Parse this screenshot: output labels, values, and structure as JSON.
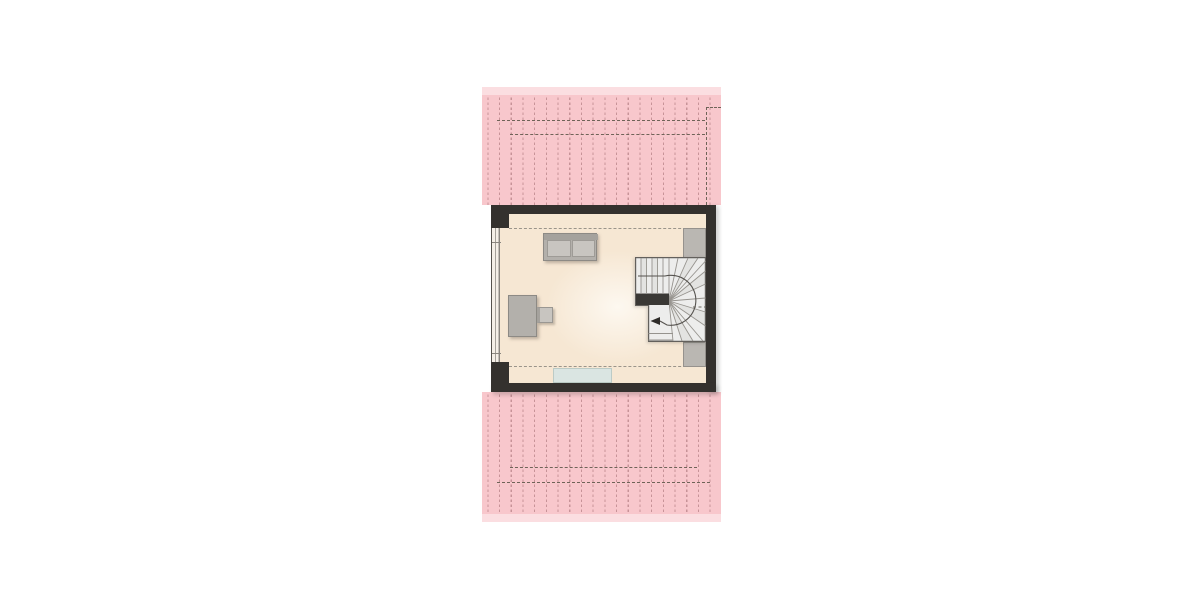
{
  "app": {
    "type": "architectural-floor-plan",
    "description": "attic floor plan with hatched roof planes, one room with sofa, desk, chair, winder staircase, side closets and doormat",
    "text_labels": []
  },
  "palette": {
    "page_bg": "#ffffff",
    "pink": "#f8c7cc",
    "pink_light": "#fbdee1",
    "hatch": "rgba(150,95,100,0.5)",
    "roof_dash": "#6f6358",
    "wall": "#34312e",
    "floor": "#f6e7d3",
    "floor_glow": "#fdf8f0",
    "room_dash": "#9a948a",
    "furn": "#b3b0ab",
    "furn_light": "#c8c5c0",
    "furn_border": "#8d8a85",
    "closet": "#bab7b2",
    "stair_fill": "#ededec",
    "stair_line": "#96938e",
    "stair_dark": "#3a3835",
    "rug": "#dae5e2",
    "win_line": "#8a867f"
  },
  "layout": {
    "canvas": {
      "x": 0,
      "y": 0,
      "w": 1200,
      "h": 600
    },
    "roof_top_fringe": {
      "x": 482,
      "y": 87,
      "w": 239,
      "h": 8
    },
    "roof_top": {
      "x": 482,
      "y": 95,
      "w": 239,
      "h": 110
    },
    "roof_top_dash_outer": {
      "x": 497,
      "y": 120,
      "w": 208,
      "h": 0
    },
    "roof_top_dash_inner": {
      "x": 510,
      "y": 134,
      "w": 195,
      "h": 0
    },
    "roof_top_dash_step_h": {
      "x": 706,
      "y": 107,
      "w": 15,
      "h": 0
    },
    "roof_top_dash_step_v": {
      "x": 706,
      "y": 107,
      "w": 0,
      "h": 98
    },
    "roof_bottom": {
      "x": 482,
      "y": 392,
      "w": 239,
      "h": 122
    },
    "roof_bottom_fringe": {
      "x": 482,
      "y": 514,
      "w": 239,
      "h": 8
    },
    "roof_bottom_dash_inner": {
      "x": 510,
      "y": 467,
      "w": 187,
      "h": 0
    },
    "roof_bottom_dash_outer": {
      "x": 497,
      "y": 482,
      "w": 213,
      "h": 0
    },
    "floor": {
      "x": 500,
      "y": 214,
      "w": 206,
      "h": 169
    },
    "room_dash_top": {
      "x": 509,
      "y": 228,
      "w": 197,
      "h": 0
    },
    "room_dash_bottom": {
      "x": 509,
      "y": 366,
      "w": 197,
      "h": 0
    },
    "rug": {
      "x": 553,
      "y": 368,
      "w": 59,
      "h": 15
    },
    "closet_top": {
      "x": 683,
      "y": 228,
      "w": 23,
      "h": 31
    },
    "closet_bottom": {
      "x": 683,
      "y": 342,
      "w": 23,
      "h": 25
    },
    "sofa": {
      "x": 543,
      "y": 233,
      "w": 54,
      "h": 28
    },
    "sofa_back": {
      "x": 0,
      "y": 0,
      "w": 54,
      "h": 6
    },
    "sofa_cushion_left": {
      "x": 3,
      "y": 6,
      "w": 24,
      "h": 17
    },
    "sofa_cushion_right": {
      "x": 28,
      "y": 6,
      "w": 23,
      "h": 17
    },
    "desk": {
      "x": 508,
      "y": 295,
      "w": 29,
      "h": 42
    },
    "chair": {
      "x": 537,
      "y": 307,
      "w": 16,
      "h": 16
    },
    "stairs": {
      "x": 635,
      "y": 257,
      "w": 73,
      "h": 85
    },
    "window_left": {
      "x": 491,
      "y": 228,
      "w": 9,
      "h": 134
    },
    "window_tick_top": {
      "x": 0,
      "y": 14,
      "w": 9,
      "h": 1
    },
    "window_tick_bottom": {
      "x": 0,
      "y": 125,
      "w": 9,
      "h": 1
    },
    "wall_top": {
      "x": 491,
      "y": 205,
      "w": 225,
      "h": 9
    },
    "wall_right": {
      "x": 706,
      "y": 205,
      "w": 10,
      "h": 187
    },
    "wall_bottom": {
      "x": 491,
      "y": 383,
      "w": 225,
      "h": 9
    },
    "corner_top_left": {
      "x": 491,
      "y": 205,
      "w": 18,
      "h": 23
    },
    "corner_bottom_left": {
      "x": 491,
      "y": 362,
      "w": 18,
      "h": 30
    }
  },
  "stairs_meta": {
    "kind": "winder-staircase",
    "direction_arrow": "left",
    "walking_line": true,
    "landing_block": true
  }
}
